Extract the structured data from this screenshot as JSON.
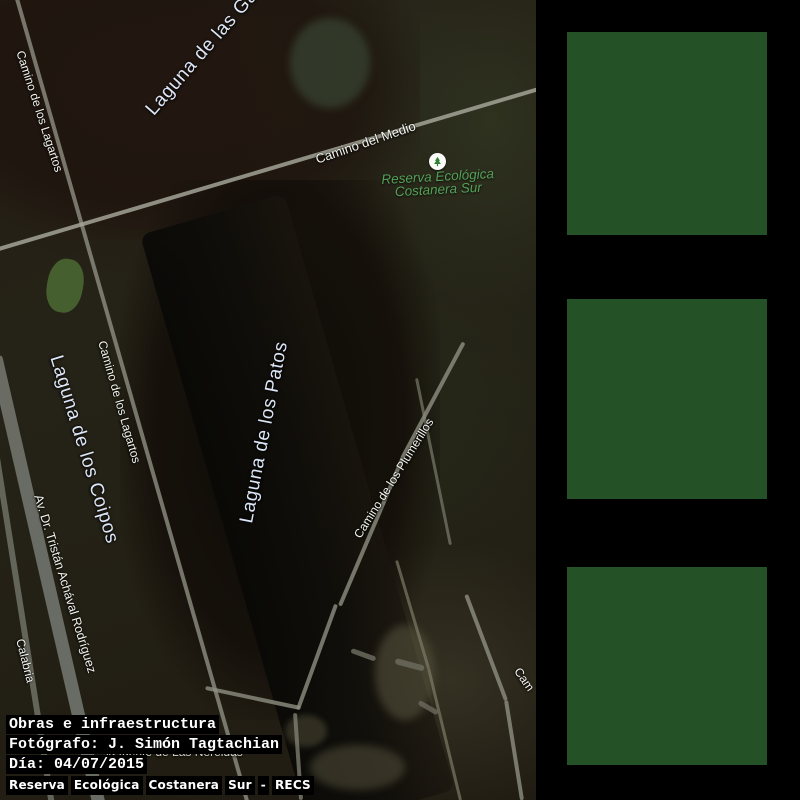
{
  "map": {
    "labels": {
      "laguna_gaviotas": "Laguna de las Ga",
      "camino_lagartos_top": "Camino de los Lagartos",
      "camino_del_medio": "Camino del Medio",
      "laguna_coipos": "Laguna de los Coipos",
      "camino_lagartos_mid": "Camino de los Lagartos",
      "laguna_patos": "Laguna de los Patos",
      "camino_plumerillos": "Camino de los Plumerillos",
      "av_tristan": "Av. Dr. Tristán Achával Rodríguez",
      "calabria": "Calabria",
      "camino_edge": "Cam",
      "nereidas": "la fuente de Las Nereidas"
    },
    "poi": {
      "line1": "Reserva Ecológica",
      "line2": "Costanera Sur",
      "icon": "tree-icon"
    }
  },
  "caption": {
    "line1": "Obras e infraestructura",
    "line2": "Fotógrafo: J. Simón Tagtachian",
    "line3": "Día: 04/07/2015",
    "line4": "Reserva Ecológica Costanera Sur - RECS"
  },
  "colors": {
    "panel_bg": "#000000",
    "placeholder_green": "#255126",
    "water_label": "#dce6f6",
    "road_label": "#f4f4ee",
    "park_label": "#54a058",
    "caption_text": "#ffffff",
    "caption_bg": "#000000"
  },
  "placeholders": {
    "count": 3
  }
}
